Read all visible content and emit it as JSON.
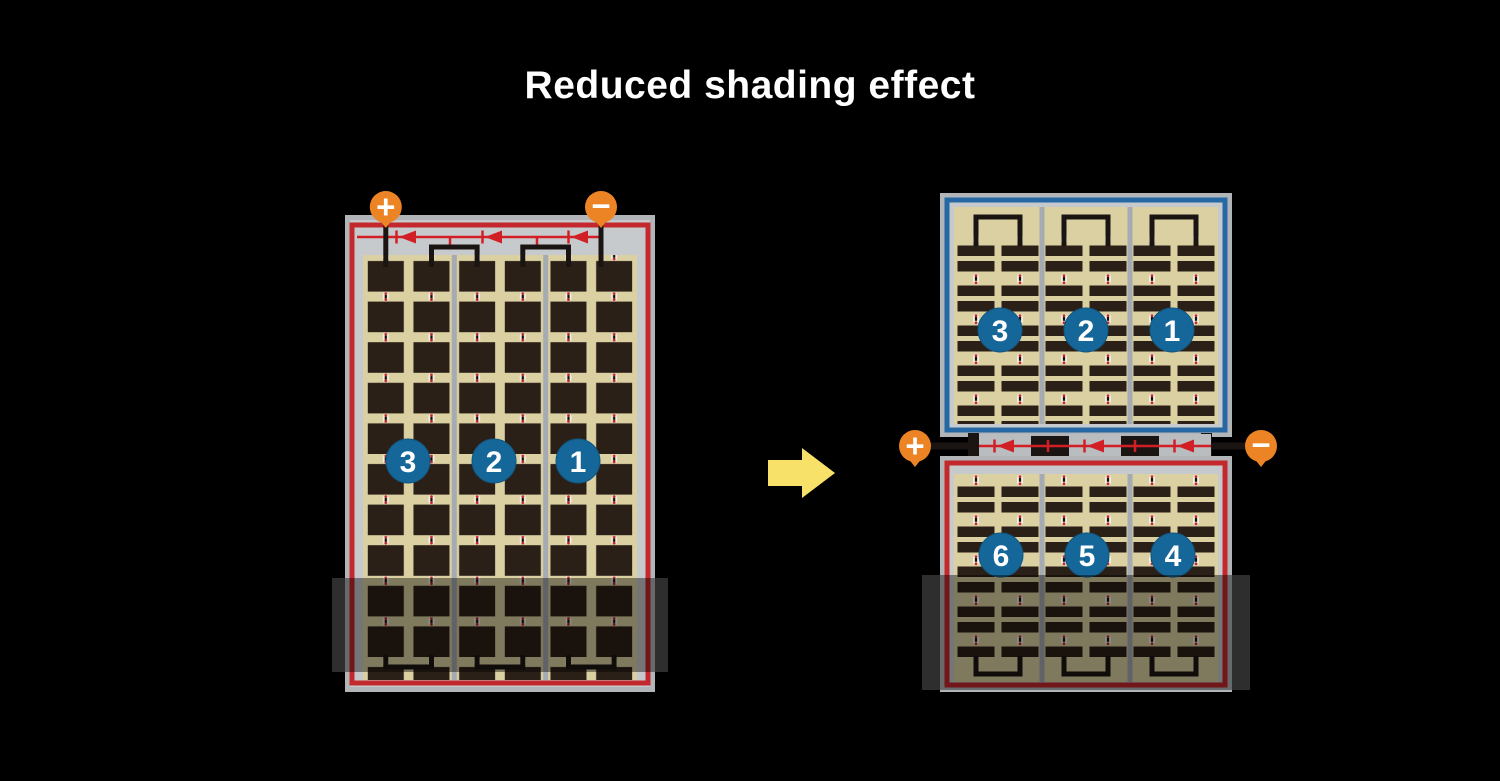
{
  "title": "Reduced shading effect",
  "left_panel": {
    "terminals": {
      "plus": "+",
      "minus": "−"
    },
    "circles": [
      {
        "label": "3"
      },
      {
        "label": "2"
      },
      {
        "label": "1"
      }
    ]
  },
  "right_panel": {
    "terminals": {
      "plus": "+",
      "minus": "−"
    },
    "top_circles": [
      {
        "label": "3"
      },
      {
        "label": "2"
      },
      {
        "label": "1"
      }
    ],
    "bottom_circles": [
      {
        "label": "6"
      },
      {
        "label": "5"
      },
      {
        "label": "4"
      }
    ]
  },
  "colors": {
    "background": "#000000",
    "title_text": "#ffffff",
    "terminal_orange": "#ec8426",
    "module_red_border": "#c3292c",
    "half_blue_border": "#2668a3",
    "badge_blue": "#15679a",
    "cell_dark": "#2b2018",
    "cell_beige": "#dbd0a2",
    "diode_red": "#d21f26",
    "arrow_yellow": "#f8e169",
    "shade_gray": "#2e2e2e"
  }
}
